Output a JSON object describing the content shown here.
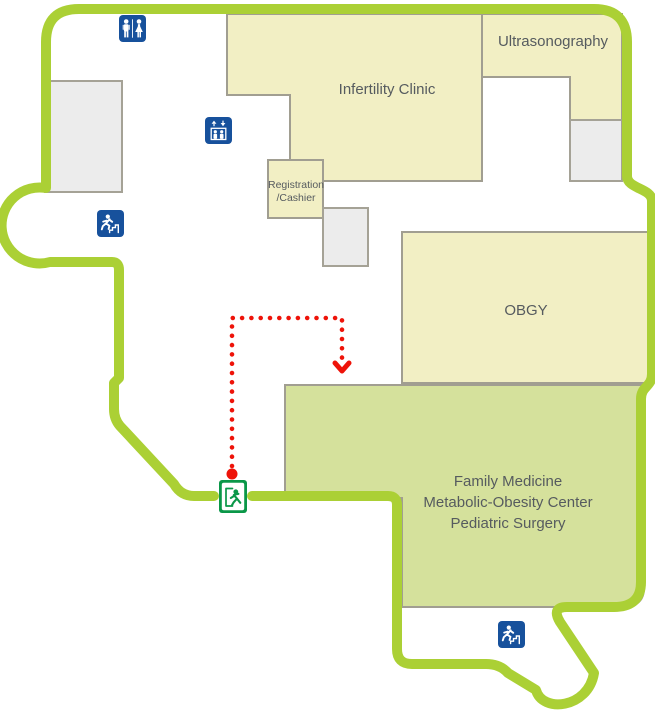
{
  "map": {
    "rooms": {
      "infertility_clinic": {
        "label": "Infertility Clinic"
      },
      "ultrasonography": {
        "label": "Ultrasonography"
      },
      "registration_cashier": {
        "line1": "Registration",
        "line2": "/Cashier"
      },
      "obgy": {
        "label": "OBGY"
      },
      "family_medicine": {
        "line1": "Family Medicine",
        "line2": "Metabolic-Obesity Center",
        "line3": "Pediatric Surgery"
      }
    },
    "icons": {
      "restroom": "men-women-restroom-icon",
      "elevator": "elevator-icon",
      "stairs_upper": "emergency-stairs-icon",
      "stairs_lower": "emergency-stairs-icon",
      "exit": "emergency-exit-icon"
    },
    "route": {
      "style": "dotted",
      "color": "#ee1309",
      "start_dot": [
        232,
        474
      ],
      "waypoints": [
        [
          232,
          466
        ],
        [
          232,
          318
        ],
        [
          342,
          318
        ],
        [
          342,
          358
        ]
      ],
      "arrow_tip": [
        342,
        371
      ]
    },
    "colors": {
      "wall": "#abd035",
      "room_fill": "#f2efc4",
      "room_border": "#a19e91",
      "highlight_room_fill": "#d5e19c",
      "utility_fill": "#ececec",
      "icon_blue": "#17519c",
      "exit_green": "#0a9748",
      "route_red": "#ee1309",
      "label_text": "#565b5f"
    }
  }
}
